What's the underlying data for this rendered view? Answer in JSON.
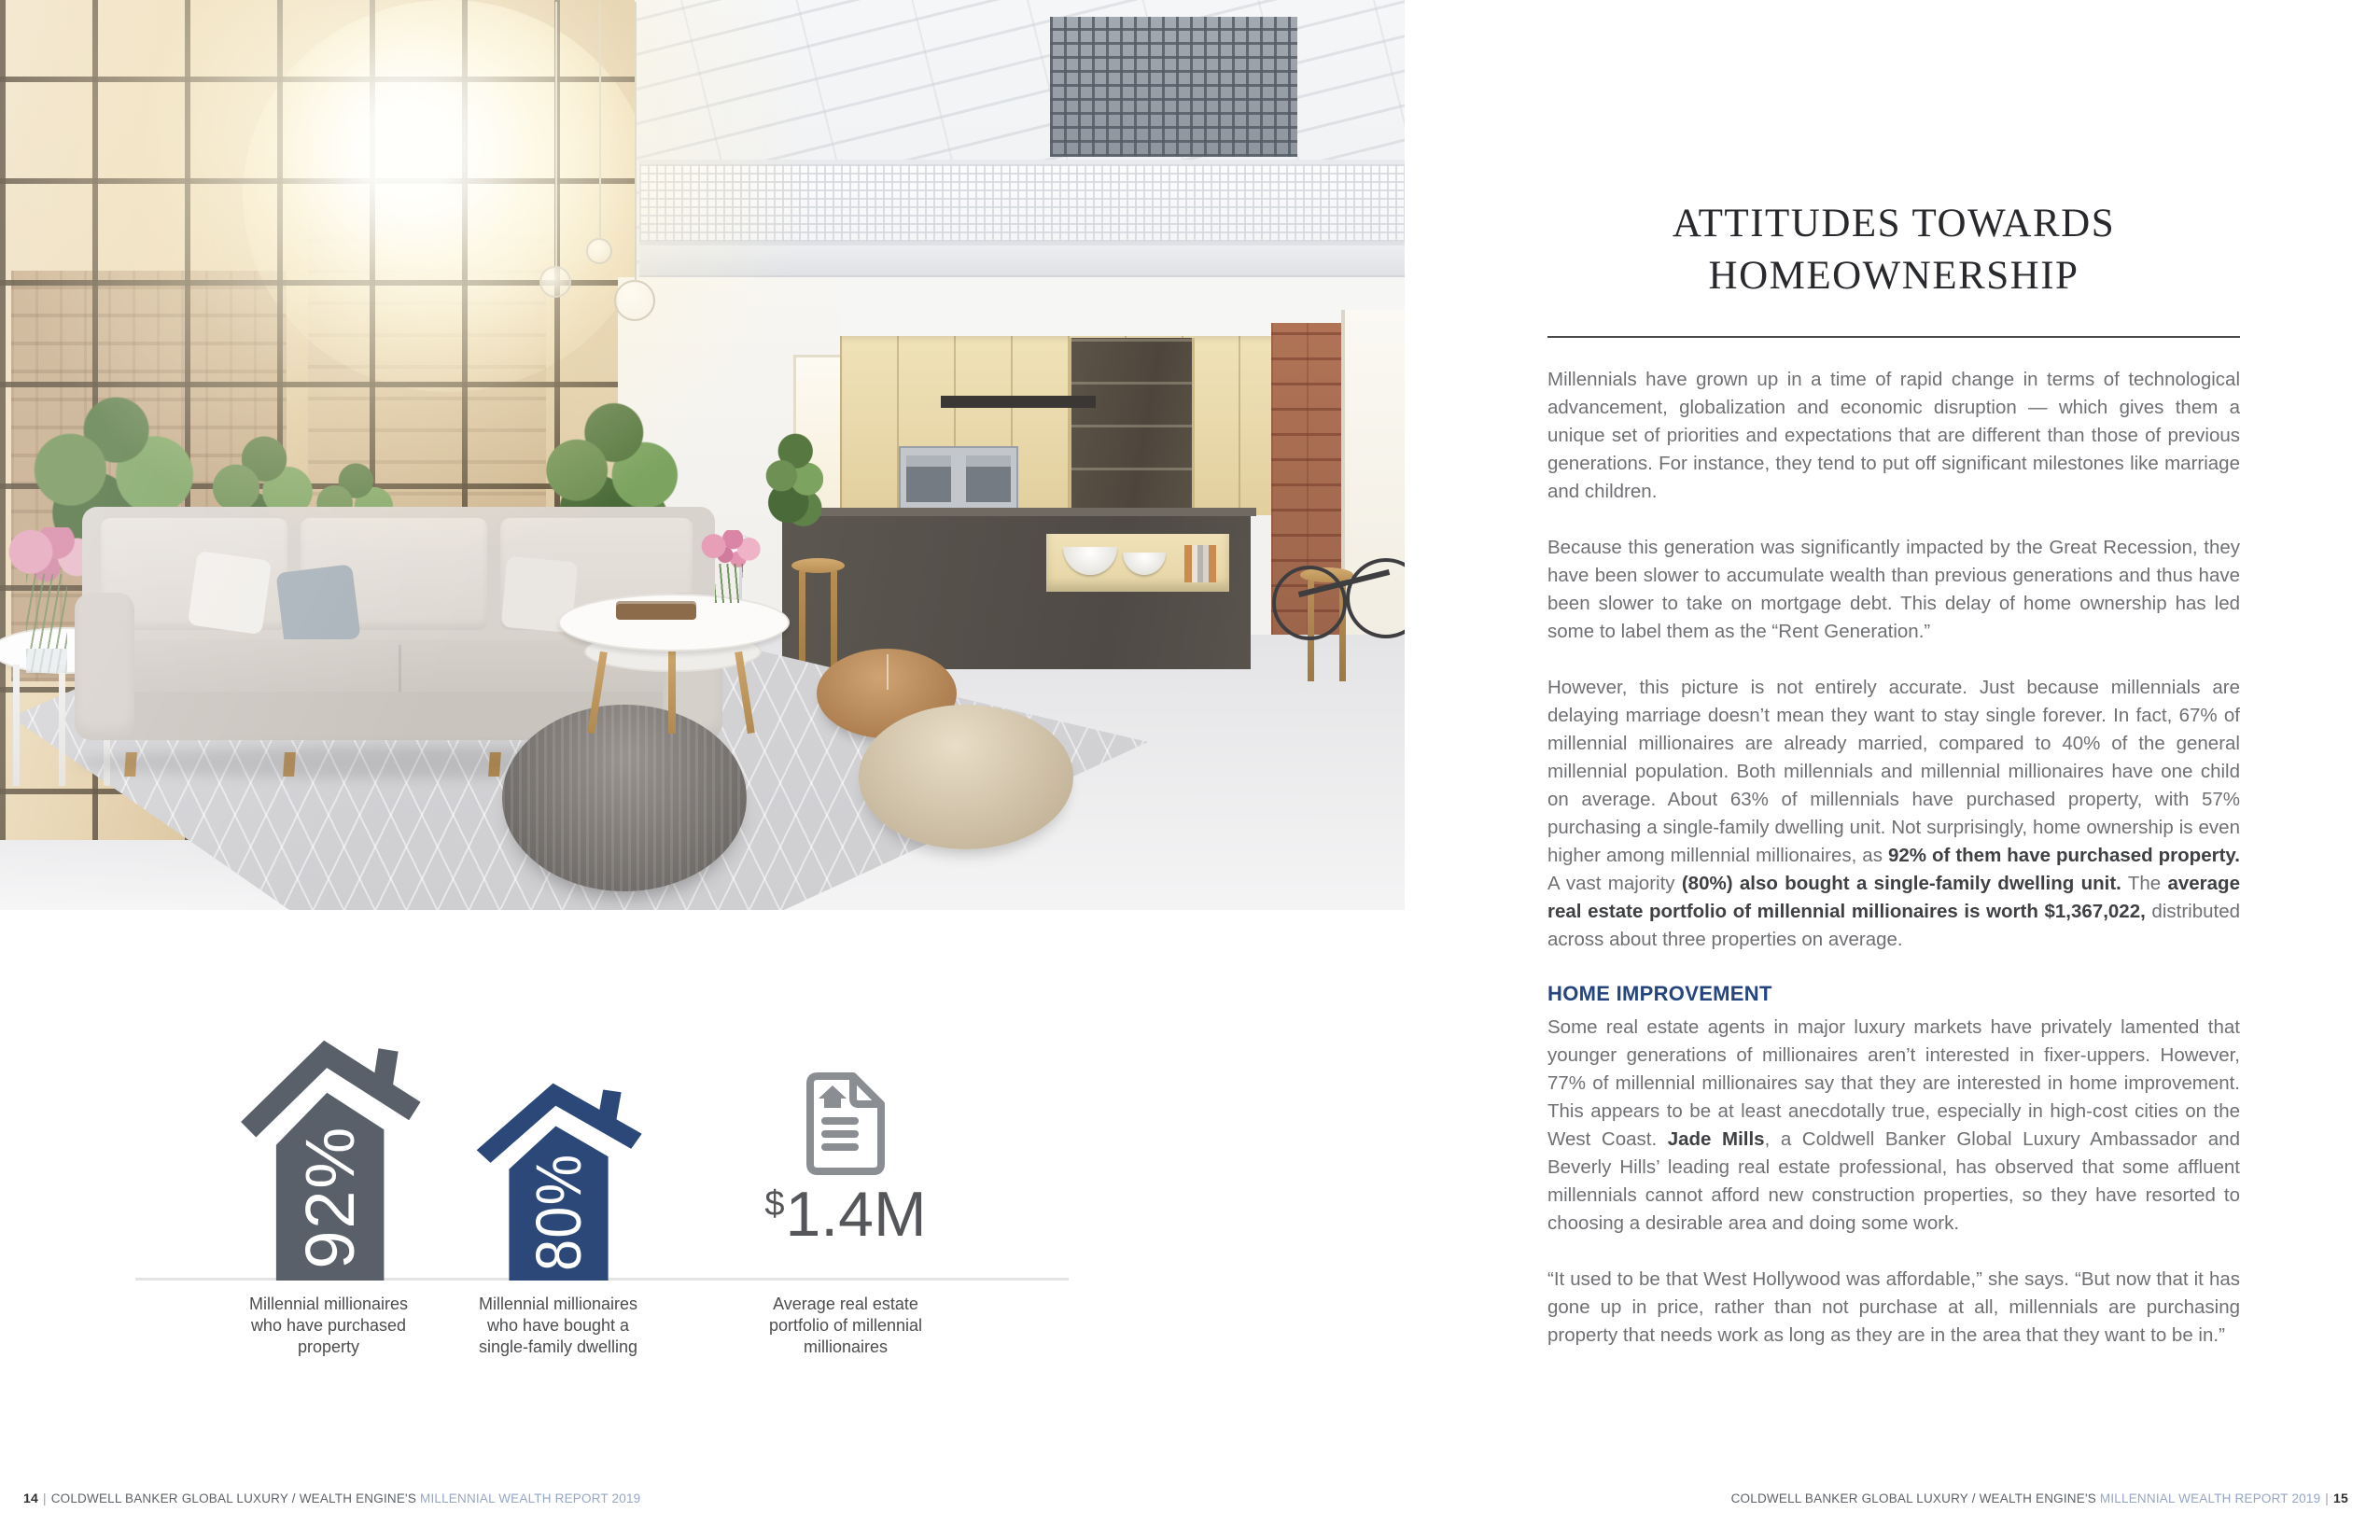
{
  "colors": {
    "house_gray": "#59606a",
    "house_blue": "#2b4878",
    "icon_gray": "#8a8d92",
    "value_gray": "#55565a",
    "heading_blue": "#24457e",
    "footer_dark": "#5d6368",
    "footer_light": "#96a6c6",
    "title": "#28292c",
    "text": "#6f7073",
    "text_bold": "#3f4043"
  },
  "article": {
    "title_line1": "ATTITUDES TOWARDS",
    "title_line2": "HOMEOWNERSHIP",
    "blocks": [
      {
        "type": "p",
        "runs": [
          {
            "t": "Millennials have grown up in a time of rapid change in terms of technological advancement, globalization and economic disruption — which gives them a unique set of priorities and expectations that are different than those of previous generations. For instance, they tend to put off significant milestones like marriage and children."
          }
        ]
      },
      {
        "type": "p",
        "runs": [
          {
            "t": "Because this generation was significantly impacted by the Great Recession, they have been slower to accumulate wealth than previous generations and thus have been slower to take on mortgage debt. This delay of home ownership has led some to label them as the “Rent Generation.”"
          }
        ]
      },
      {
        "type": "p",
        "runs": [
          {
            "t": "However, this picture is not entirely accurate. Just because millennials are delaying marriage doesn’t mean they want to stay single forever. In fact, 67% of millennial millionaires are already married, compared to 40% of the general millennial population. Both millennials and millennial millionaires have one child on average. About 63% of millennials have purchased property, with 57% purchasing a single-family dwelling unit. Not surprisingly, home ownership is even higher among millennial millionaires, as "
          },
          {
            "t": "92% of them have purchased property.",
            "b": true
          },
          {
            "t": " A vast majority "
          },
          {
            "t": "(80%) also bought a single-family dwelling unit.",
            "b": true
          },
          {
            "t": " The "
          },
          {
            "t": "average real estate portfolio of millennial millionaires is worth $1,367,022,",
            "b": true
          },
          {
            "t": " distributed across about three properties on average."
          }
        ]
      },
      {
        "type": "h2",
        "text": "HOME IMPROVEMENT"
      },
      {
        "type": "p",
        "runs": [
          {
            "t": "Some real estate agents in major luxury markets have privately lamented that younger generations of millionaires aren’t interested in fixer-uppers. However, 77% of millennial millionaires say that they are interested in home improvement. This appears to be at least anecdotally true, especially in high-cost cities on the West Coast. "
          },
          {
            "t": "Jade Mills",
            "b": true
          },
          {
            "t": ", a Coldwell Banker Global Luxury Ambassador and Beverly Hills’ leading real estate professional, has observed that some affluent millennials cannot afford new construction properties, so they have resorted to choosing a desirable area and doing some work."
          }
        ]
      },
      {
        "type": "p",
        "runs": [
          {
            "t": "“It used to be that West Hollywood was affordable,” she says. “But now that it has gone up in price, rather than not purchase at all, millennials are purchasing property that needs work as long as they are in the area that they want to be in.”"
          }
        ]
      }
    ]
  },
  "infographics": {
    "items": [
      {
        "icon": "house-icon",
        "value": "92%",
        "label": "Millennial millionaires\nwho have purchased\nproperty"
      },
      {
        "icon": "house-icon",
        "value": "80%",
        "label": "Millennial millionaires\nwho have bought a\nsingle-family dwelling"
      },
      {
        "icon": "property-document-icon",
        "value_prefix": "$",
        "value": "1.4M",
        "label": "Average real estate\nportfolio of millennial\nmillionaires"
      }
    ]
  },
  "footer": {
    "separator": "|",
    "brand": "COLDWELL BANKER GLOBAL LUXURY / WEALTH ENGINE'S",
    "report": "MILLENNIAL WEALTH REPORT 2019",
    "left_page": "14",
    "right_page": "15"
  }
}
